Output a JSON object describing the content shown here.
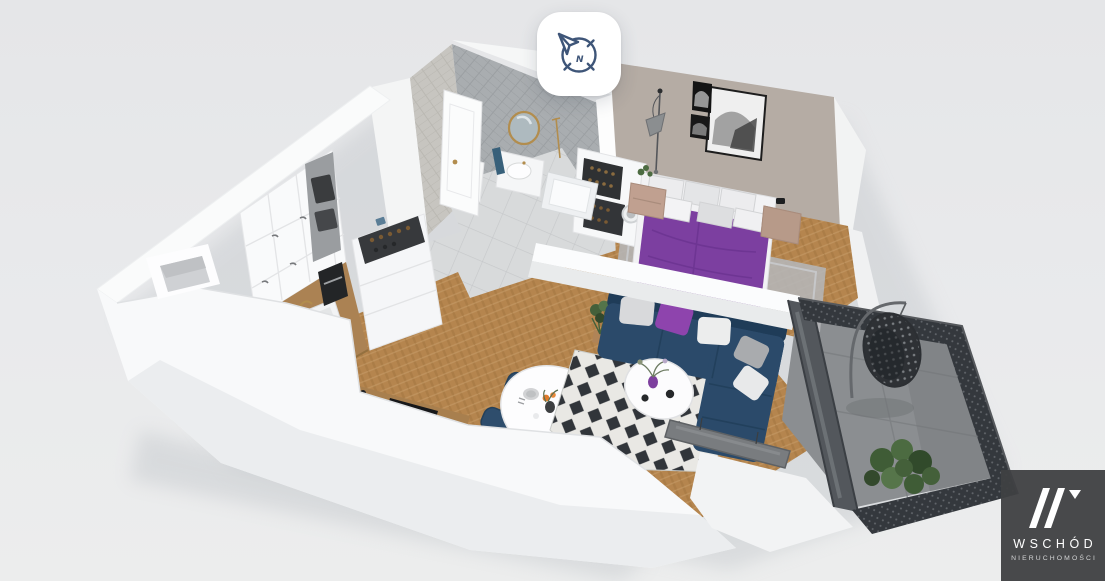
{
  "scene": {
    "type": "3d-apartment-floorplan-cutaway-render",
    "background_color": "#e8e9eb"
  },
  "compass_button": {
    "icon": "compass-north-icon",
    "north_letter": "N",
    "icon_color": "#3e5578",
    "background": "#ffffff"
  },
  "watermark": {
    "logo_mark": "double-slash-w-monogram",
    "brand": "WSCHÓD",
    "subtitle": "NIERUCHOMOŚCI",
    "background": "#3f4042",
    "brand_color": "#ffffff",
    "subtitle_color": "#d4d5d6"
  },
  "floorplan": {
    "style": "white cut walls, angled top-down 3D view",
    "rooms": [
      {
        "name": "kitchen",
        "objects": [
          "white tall cabinets",
          "oven column",
          "wood countertop with sink",
          "coffee machine",
          "wine storage cabinet",
          "black induction hob"
        ]
      },
      {
        "name": "dining-area",
        "objects": [
          "oval white table",
          "navy upholstered chairs",
          "set plates and cutlery",
          "orange flowers"
        ]
      },
      {
        "name": "living-room",
        "objects": [
          "navy corner sofa",
          "purple and gray throw pillows",
          "black-white diamond rug",
          "round white coffee table",
          "purple vase",
          "tv leaning on half wall",
          "potted plant"
        ]
      },
      {
        "name": "bedroom",
        "objects": [
          "double bed with purple duvet",
          "white gray pillows",
          "two blush nightstands",
          "arc floor lamp",
          "three black-frame artworks",
          "gray rug",
          "storage unit with washing machine and racks"
        ]
      },
      {
        "name": "bathroom",
        "objects": [
          "herringbone tile walls",
          "round gold mirror",
          "white vanity with sink",
          "bathtub",
          "navy towel",
          "gold fixtures"
        ]
      },
      {
        "name": "hallway",
        "objects": [
          "entrance door",
          "gray tile floor",
          "wall shaft cutout"
        ]
      },
      {
        "name": "balcony",
        "objects": [
          "perforated dark railing",
          "concrete floor",
          "rattan hanging egg chair",
          "green plant",
          "dark glass sliding door"
        ]
      }
    ],
    "palette": {
      "wall": "#fafbfc",
      "bedroom_wall": "#b5aca4",
      "bath_tile": "#a9adb0",
      "wood_floor": "#b5854e",
      "tile_floor": "#d8dadb",
      "rug_dark": "#31353a",
      "rug_light": "#e9e8e4",
      "sofa": "#2b4a6a",
      "accent_purple": "#8e44ad",
      "bed_purple": "#7c3fa0",
      "nightstand": "#bb9d8d",
      "balcony_floor": "#8b8e91",
      "railing": "#34383d",
      "plant": "#44603a",
      "gold": "#b28d4e",
      "tv": "#797c7f"
    }
  }
}
